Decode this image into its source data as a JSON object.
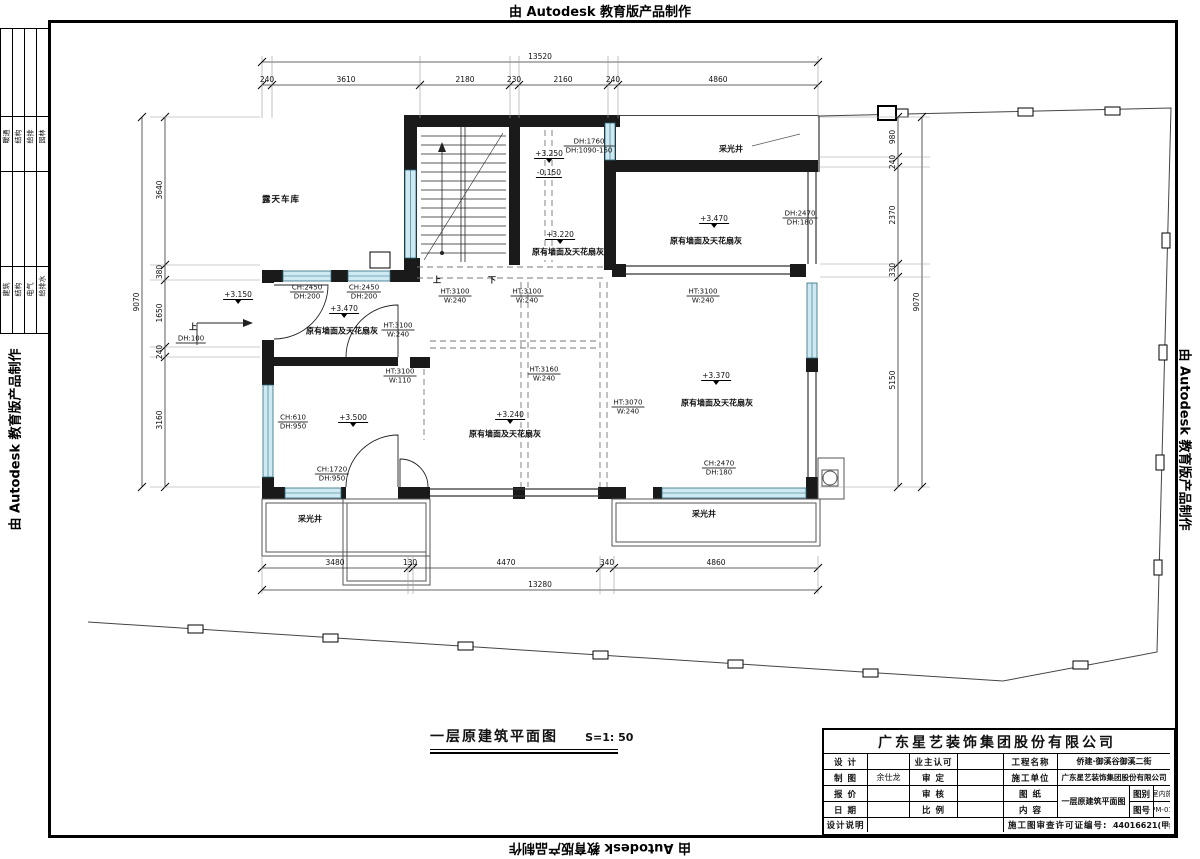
{
  "banner": {
    "text": "由 Autodesk 教育版产品制作"
  },
  "margin_stamp": {
    "top_cells": [
      "暖通",
      "结构",
      "给排",
      "园林"
    ],
    "bottom_cells": [
      "建筑",
      "结构",
      "电气",
      "给排水"
    ]
  },
  "plan": {
    "title": "一层原建筑平面图",
    "scale": "S=1: 50",
    "room_labels": [
      {
        "t": "露天车库",
        "x": 281,
        "y": 199,
        "cls": "big"
      },
      {
        "t": "采光井",
        "x": 731,
        "y": 149,
        "cls": ""
      },
      {
        "t": "采光井",
        "x": 310,
        "y": 519,
        "cls": ""
      },
      {
        "t": "采光井",
        "x": 704,
        "y": 514,
        "cls": ""
      },
      {
        "t": "原有墙面及天花扇灰",
        "x": 568,
        "y": 252,
        "cls": ""
      },
      {
        "t": "原有墙面及天花扇灰",
        "x": 706,
        "y": 241,
        "cls": ""
      },
      {
        "t": "原有墙面及天花扇灰",
        "x": 342,
        "y": 331,
        "cls": ""
      },
      {
        "t": "原有墙面及天花扇灰",
        "x": 505,
        "y": 434,
        "cls": ""
      },
      {
        "t": "原有墙面及天花扇灰",
        "x": 717,
        "y": 403,
        "cls": ""
      },
      {
        "t": "上",
        "x": 437,
        "y": 280,
        "cls": ""
      },
      {
        "t": "下",
        "x": 492,
        "y": 280,
        "cls": ""
      },
      {
        "t": "上",
        "x": 193,
        "y": 327,
        "cls": ""
      }
    ],
    "levels": [
      {
        "t": "+3.250",
        "x": 549,
        "y": 156,
        "plain": false
      },
      {
        "t": "-0.150",
        "x": 549,
        "y": 173,
        "plain": true
      },
      {
        "t": "+3.220",
        "x": 560,
        "y": 237,
        "plain": false
      },
      {
        "t": "+3.470",
        "x": 714,
        "y": 221,
        "plain": false
      },
      {
        "t": "+3.470",
        "x": 344,
        "y": 311,
        "plain": false
      },
      {
        "t": "+3.240",
        "x": 510,
        "y": 417,
        "plain": false
      },
      {
        "t": "+3.370",
        "x": 716,
        "y": 378,
        "plain": false
      },
      {
        "t": "+3.500",
        "x": 353,
        "y": 420,
        "plain": false
      },
      {
        "t": "+3.150",
        "x": 238,
        "y": 297,
        "plain": false
      }
    ],
    "tags": [
      {
        "l1": "DH:1760",
        "l2": "DH:1090-150",
        "x": 589,
        "y": 146
      },
      {
        "l1": "CH:2450",
        "l2": "DH:200",
        "x": 307,
        "y": 292
      },
      {
        "l1": "CH:2450",
        "l2": "DH:200",
        "x": 364,
        "y": 292
      },
      {
        "l1": "HT:3100",
        "l2": "W:240",
        "x": 455,
        "y": 296
      },
      {
        "l1": "HT:3100",
        "l2": "W:240",
        "x": 527,
        "y": 296
      },
      {
        "l1": "HT:3100",
        "l2": "W:240",
        "x": 703,
        "y": 296
      },
      {
        "l1": "HT:3100",
        "l2": "W:240",
        "x": 398,
        "y": 330
      },
      {
        "l1": "HT:3100",
        "l2": "W:110",
        "x": 400,
        "y": 376
      },
      {
        "l1": "HT:3160",
        "l2": "W:240",
        "x": 544,
        "y": 374
      },
      {
        "l1": "HT:3070",
        "l2": "W:240",
        "x": 628,
        "y": 407
      },
      {
        "l1": "CH:610",
        "l2": "DH:950",
        "x": 293,
        "y": 422
      },
      {
        "l1": "CH:1720",
        "l2": "DH:950",
        "x": 332,
        "y": 474
      },
      {
        "l1": "CH:2470",
        "l2": "DH:180",
        "x": 719,
        "y": 468
      },
      {
        "l1": "DH:2470",
        "l2": "DH:180",
        "x": 800,
        "y": 218
      },
      {
        "l1": "DH:100",
        "l2": "",
        "x": 191,
        "y": 339
      }
    ],
    "dims": {
      "top": {
        "o": "h",
        "tier": 85,
        "tierA": 262,
        "tierB": 818,
        "ticks": [
          262,
          272,
          420,
          510,
          519,
          608,
          618,
          818
        ],
        "parts": [
          {
            "t": "240",
            "c": 267
          },
          {
            "t": "3610",
            "c": 346
          },
          {
            "t": "2180",
            "c": 465
          },
          {
            "t": "230",
            "c": 514
          },
          {
            "t": "2160",
            "c": 563
          },
          {
            "t": "240",
            "c": 613
          },
          {
            "t": "4860",
            "c": 718
          }
        ],
        "total": {
          "t": "13520",
          "c": 540
        },
        "totalPos": 62,
        "ext": [
          56,
          118
        ]
      },
      "bottom": {
        "o": "h",
        "tier": 568,
        "tierA": 262,
        "tierB": 818,
        "ticks": [
          262,
          408,
          413,
          600,
          614,
          818
        ],
        "parts": [
          {
            "t": "3480",
            "c": 335
          },
          {
            "t": "130",
            "c": 410
          },
          {
            "t": "4470",
            "c": 506
          },
          {
            "t": "340",
            "c": 607
          },
          {
            "t": "4860",
            "c": 716
          }
        ],
        "total": {
          "t": "13280",
          "c": 540
        },
        "totalPos": 590,
        "ext": [
          556,
          594
        ]
      },
      "left": {
        "o": "v",
        "tier": 165,
        "tierA": 117,
        "tierB": 487,
        "ticks": [
          117,
          265,
          280,
          347,
          357,
          487
        ],
        "parts": [
          {
            "t": "3640",
            "c": 190
          },
          {
            "t": "380",
            "c": 272
          },
          {
            "t": "1650",
            "c": 313
          },
          {
            "t": "240",
            "c": 352
          },
          {
            "t": "3160",
            "c": 420
          }
        ],
        "total": {
          "t": "9070",
          "c": 302
        },
        "totalPos": 142,
        "ext": [
          150,
          260
        ]
      },
      "right": {
        "o": "v",
        "tier": 898,
        "tierA": 117,
        "tierB": 487,
        "ticks": [
          117,
          157,
          167,
          264,
          277,
          487
        ],
        "parts": [
          {
            "t": "980",
            "c": 137
          },
          {
            "t": "240",
            "c": 162
          },
          {
            "t": "2370",
            "c": 215
          },
          {
            "t": "330",
            "c": 270
          },
          {
            "t": "5150",
            "c": 380
          }
        ],
        "total": {
          "t": "9070",
          "c": 302
        },
        "totalPos": 922,
        "ext": [
          820,
          930
        ]
      }
    }
  },
  "title_block": {
    "company": "广东星艺装饰集团股份有限公司",
    "fields": {
      "design": "设 计",
      "owner": "业主认可",
      "project": "工程名称",
      "draft": "制 图",
      "approve": "审 定",
      "builder": "施工单位",
      "quote": "报 价",
      "check": "审 核",
      "sheet": "图 纸",
      "date": "日 期",
      "ratio": "比 例",
      "content": "内 容",
      "note": "设计说明",
      "category": "图别",
      "number": "图号",
      "permit": "施工图审查许可证编号:"
    },
    "values": {
      "draftsman": "余仕龙",
      "project": "侨建·御溪谷御溪二街",
      "builder": "广东星艺装饰集团股份有限公司",
      "drawing": "一层原建筑平面图",
      "category": "室内施",
      "number": "PM-01",
      "permit_no": "A144016621(甲级)"
    }
  }
}
